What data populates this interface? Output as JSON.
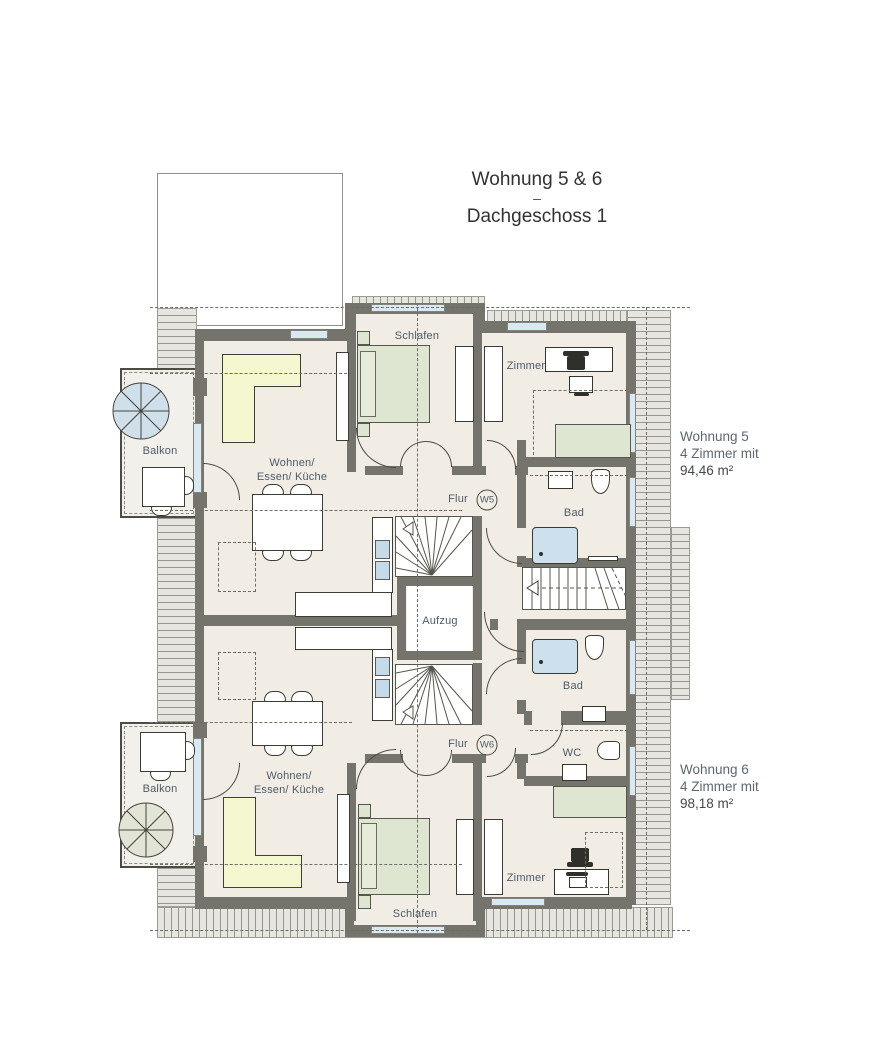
{
  "title": {
    "line1": "Wohnung 5 & 6",
    "separator": "–",
    "line2": "Dachgeschoss 1"
  },
  "apartments": {
    "wohnung5": {
      "name": "Wohnung 5",
      "rooms_line": "4 Zimmer mit",
      "area": "94,46 m²",
      "badge": "W5"
    },
    "wohnung6": {
      "name": "Wohnung 6",
      "rooms_line": "4 Zimmer mit",
      "area": "98,18 m²",
      "badge": "W6"
    }
  },
  "room_labels": {
    "schlafen": "Schlafen",
    "zimmer": "Zimmer",
    "wohnen": "Wohnen/",
    "essen_kueche": "Essen/ Küche",
    "flur": "Flur",
    "bad": "Bad",
    "wc": "WC",
    "balkon": "Balkon",
    "aufzug": "Aufzug"
  },
  "colors": {
    "wall": "#74746c",
    "floor": "#f2ede4",
    "bed_green": "#dee6d2",
    "sofa_yellow": "#f4f7cf",
    "water_blue": "#cde0ed",
    "window_blue": "#d8e9f2",
    "roof_hatch": "#e6e5df",
    "label_text": "#4d5b69"
  }
}
